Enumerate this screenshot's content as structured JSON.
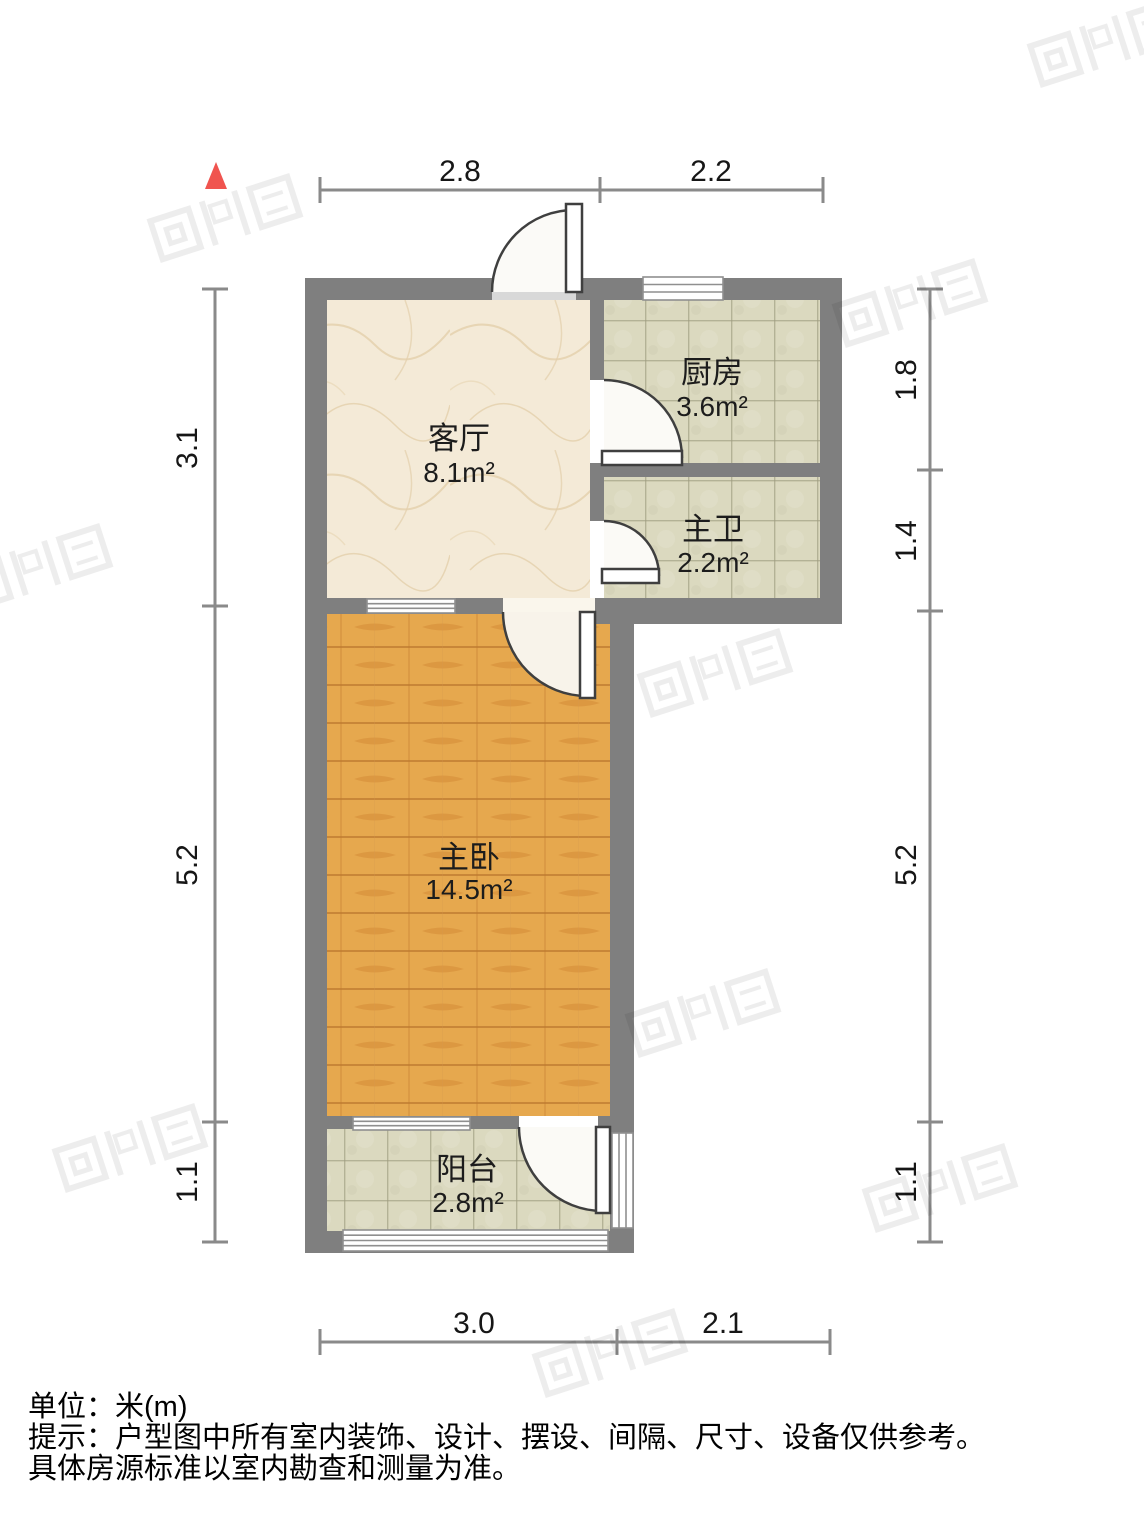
{
  "plan": {
    "rooms": [
      {
        "name": "客厅",
        "area": "8.1m²"
      },
      {
        "name": "厨房",
        "area": "3.6m²"
      },
      {
        "name": "主卫",
        "area": "2.2m²"
      },
      {
        "name": "主卧",
        "area": "14.5m²"
      },
      {
        "name": "阳台",
        "area": "2.8m²"
      }
    ],
    "dimensions": {
      "top": [
        "2.8",
        "2.2"
      ],
      "bottom": [
        "3.0",
        "2.1"
      ],
      "left": [
        "3.1",
        "5.2",
        "1.1"
      ],
      "right": [
        "1.8",
        "1.4",
        "5.2",
        "1.1"
      ]
    },
    "colors": {
      "wall": "#7f7f7f",
      "dimension_line": "#8a8a8a",
      "north_arrow": "#f0544f",
      "marble_floor": "#f4ead7",
      "tile_floor": "#dbd9bf",
      "wood_floor": "#e6a84e"
    }
  },
  "footer": {
    "unit": "单位：米(m)",
    "note1": "提示：户型图中所有室内装饰、设计、摆设、间隔、尺寸、设备仅供参考。",
    "note2": "具体房源标准以室内勘查和测量为准。"
  }
}
